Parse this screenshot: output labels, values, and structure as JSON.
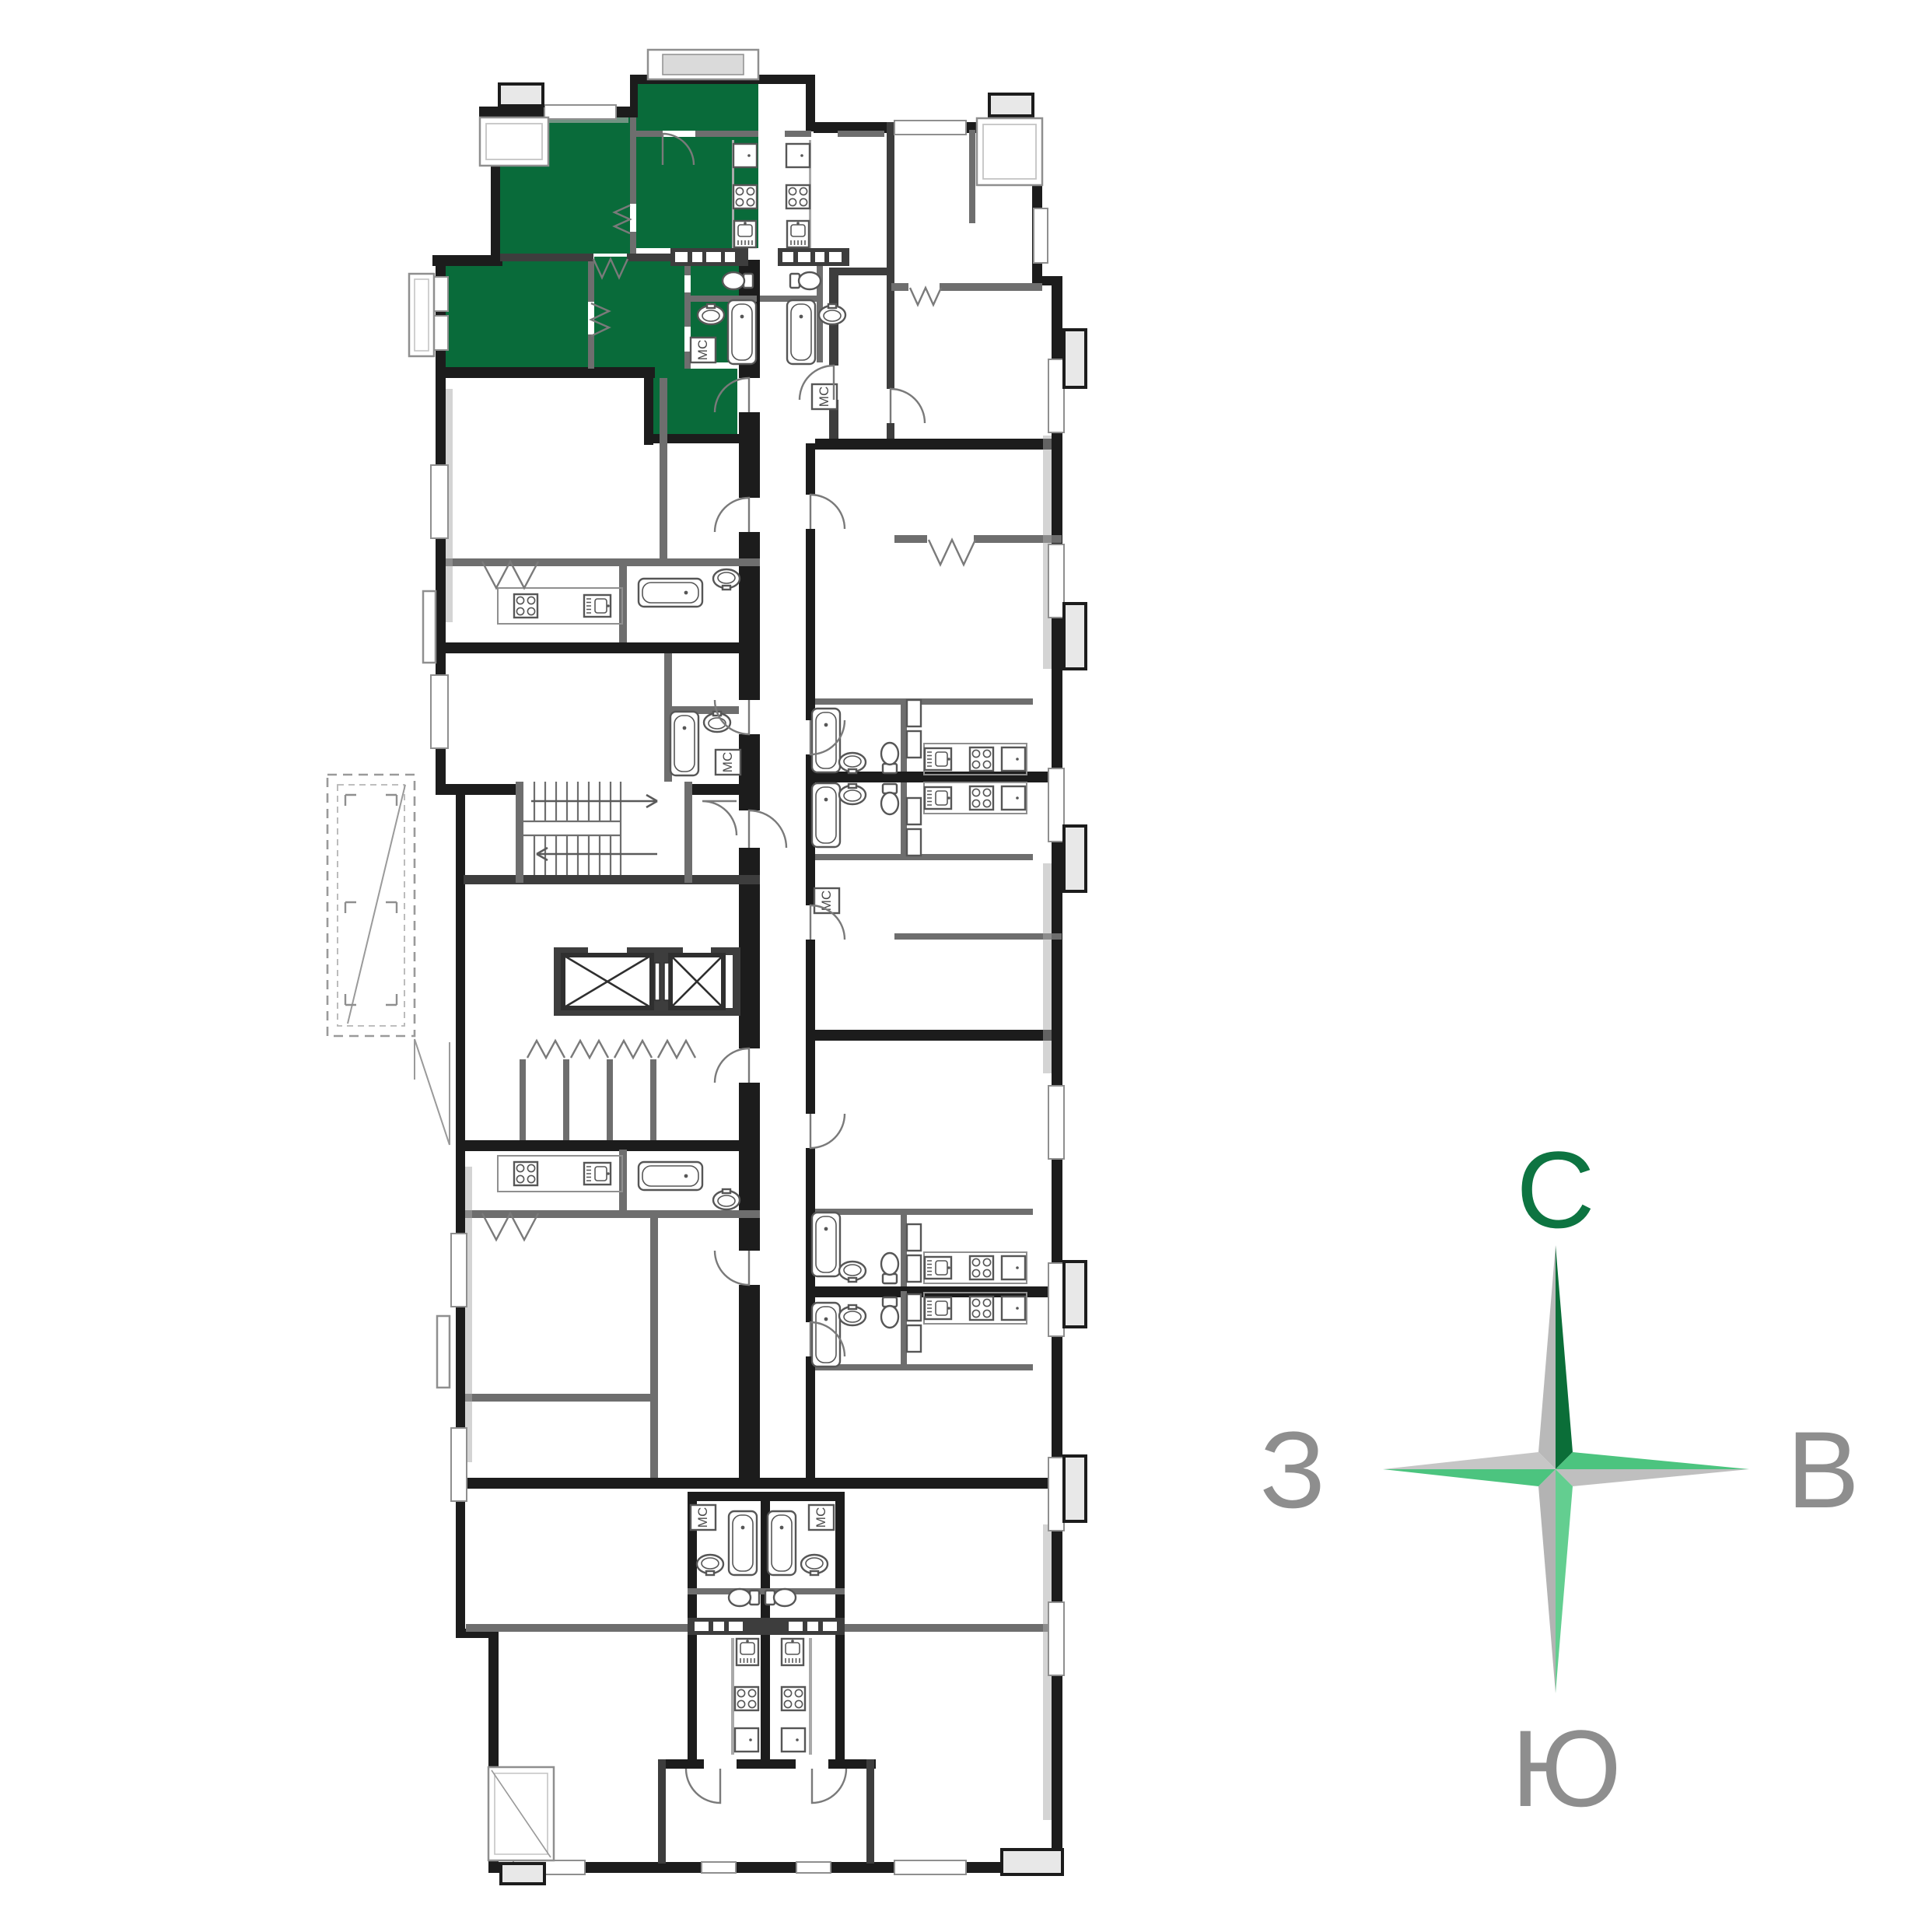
{
  "compass": {
    "north": "С",
    "east": "В",
    "south": "Ю",
    "west": "З"
  },
  "labels": {
    "washer": "МС"
  },
  "colors": {
    "highlighted_unit": "#096B3A",
    "compass_north_letter": "#0D7441",
    "compass_dark_green": "#0B6E38",
    "compass_mid_green": "#4CC47F",
    "compass_light_green": "#63CE90",
    "compass_letter_gray": "#8E8E8E",
    "star_gray": "#B9B9B9",
    "wall_dark": "#1C1C1C",
    "wall_gray": "#6E6E6E",
    "balcony_fill": "#E8E8E8"
  }
}
